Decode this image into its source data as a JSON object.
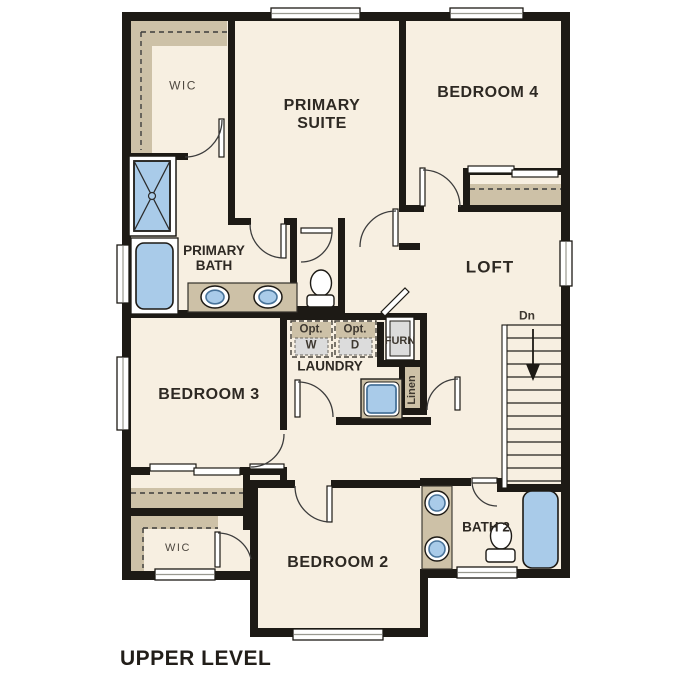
{
  "plan_title": "UPPER LEVEL",
  "rooms": {
    "wic_top": "WIC",
    "primary_suite": "PRIMARY SUITE",
    "bedroom4": "BEDROOM 4",
    "primary_bath": "PRIMARY BATH",
    "loft": "LOFT",
    "bedroom3": "BEDROOM 3",
    "laundry": "LAUNDRY",
    "bedroom2": "BEDROOM 2",
    "bath2": "BATH 2",
    "wic_bottom": "WIC"
  },
  "annotations": {
    "opt_washer": {
      "line1": "Opt.",
      "line2": "W"
    },
    "opt_dryer": {
      "line1": "Opt.",
      "line2": "D"
    },
    "furnace": "FURN",
    "linen": "Linen",
    "stairs_direction": "Dn"
  },
  "colors": {
    "wall": "#1d1a15",
    "floor": "#f7efe1",
    "closet_shelf": "#cdc1a7",
    "fixture_blue": "#a9cbe9",
    "fixture_blue_edge": "#48739a",
    "appliance_gray": "#dcdcdc",
    "door_arc": "#3c3c3c",
    "label_text": "#2e2923"
  }
}
